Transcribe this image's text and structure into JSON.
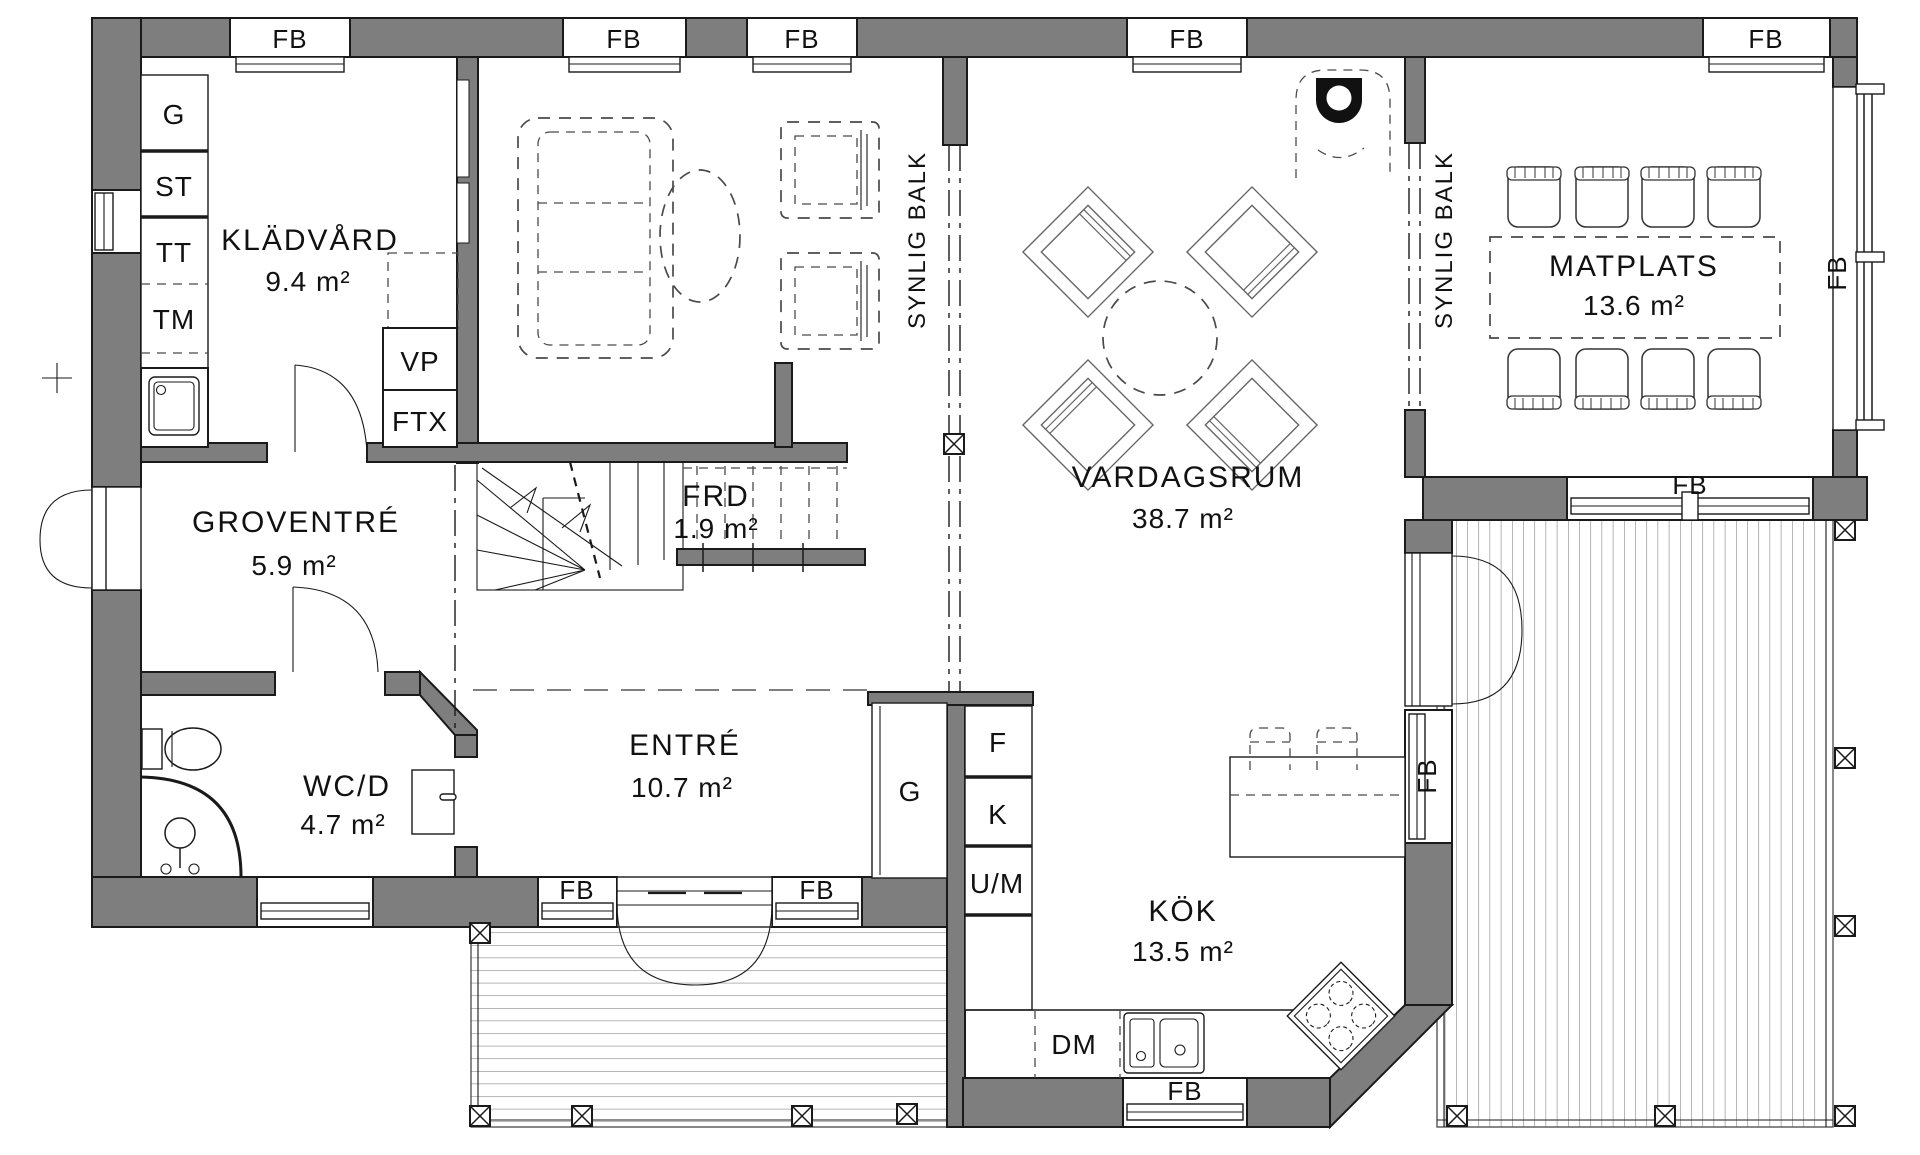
{
  "drawing": {
    "kind": "architectural floor plan",
    "floor": "ground floor"
  },
  "colors": {
    "wall": "#7e7e7e",
    "line": "#1a1a1a",
    "background": "#ffffff"
  },
  "labels": {
    "window": "FB",
    "beam": "SYNLIG BALK"
  },
  "rooms": {
    "kladvard": {
      "name": "KLÄDVÅRD",
      "area": "9.4 m²"
    },
    "groventre": {
      "name": "GROVENTRÉ",
      "area": "5.9 m²"
    },
    "wcd": {
      "name": "WC/D",
      "area": "4.7 m²"
    },
    "entre": {
      "name": "ENTRÉ",
      "area": "10.7 m²"
    },
    "frd": {
      "name": "FRD",
      "area": "1.9 m²"
    },
    "vardagsrum": {
      "name": "VARDAGSRUM",
      "area": "38.7 m²"
    },
    "kok": {
      "name": "KÖK",
      "area": "13.5 m²"
    },
    "matplats": {
      "name": "MATPLATS",
      "area": "13.6 m²"
    }
  },
  "fixtures": {
    "cabinet": "G",
    "cleaning_closet": "ST",
    "dryer": "TT",
    "washer": "TM",
    "heat_pump": "VP",
    "ventilation_unit": "FTX",
    "hall_closet": "G",
    "freezer": "F",
    "fridge": "K",
    "oven_micro": "U/M",
    "dishwasher": "DM"
  }
}
